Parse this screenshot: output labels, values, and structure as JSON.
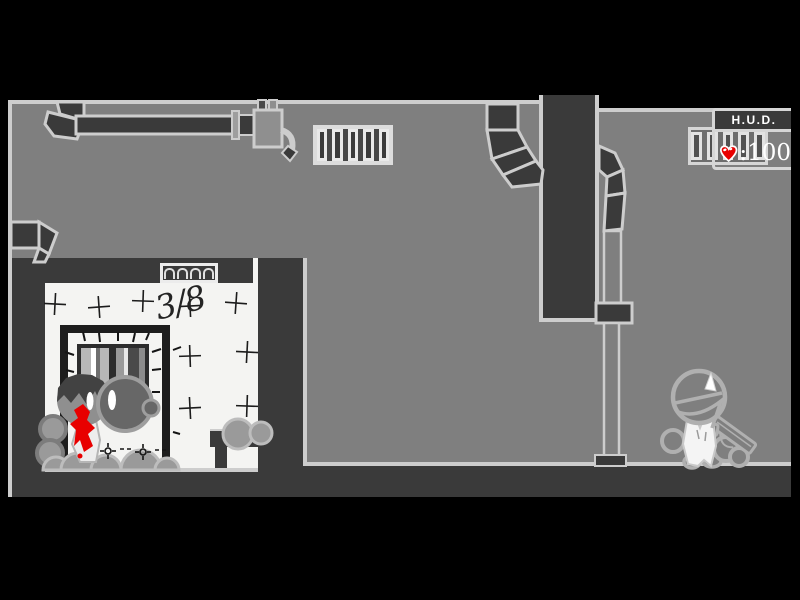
{
  "hud": {
    "title": "H.U.D.",
    "health_display": ":100",
    "health_value": 100,
    "heart_icon": "heart-icon",
    "heart_color": "#e80000",
    "text_color": "#ffffff"
  },
  "scene": {
    "graffiti": "3/8",
    "objects": [
      "air-ducts",
      "wall-grill",
      "transom-vent",
      "barred-window",
      "doorway",
      "body-pile",
      "bench",
      "standpipe",
      "player-with-pistol"
    ],
    "blood_color": "#e80000"
  },
  "colors": {
    "frame": "#000000",
    "wall_gray": "#7f7f7f",
    "wall_dark": "#3a3a3a",
    "room_white": "#f4f4f2",
    "outline_light": "#cdcdcd"
  }
}
